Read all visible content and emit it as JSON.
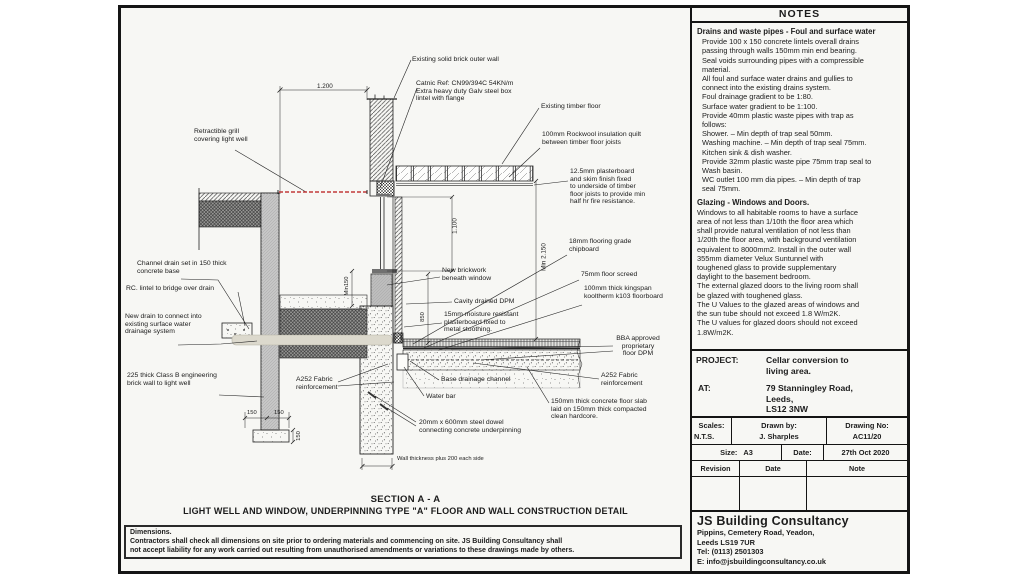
{
  "sheet": {
    "notes": {
      "title": "NOTES",
      "section1_heading": "Drains and waste pipes - Foul and surface water",
      "section1_lines": [
        "Provide 100 x 150 concrete lintels overall drains",
        "passing through walls 150mm min end bearing.",
        "Seal voids surrounding pipes with a compressible",
        "material.",
        "All foul and surface water drains and gullies to",
        "connect into the existing drains system.",
        "Foul drainage gradient to be 1:80.",
        "Surface water gradient to be 1:100.",
        "Provide 40mm plastic waste pipes with trap as",
        "follows:",
        "Shower. – Min depth of trap seal 50mm.",
        "Washing machine. – Min depth of trap seal 75mm.",
        "Kitchen sink & dish washer.",
        "Provide 32mm plastic waste pipe 75mm trap seal to",
        "Wash basin.",
        "WC outlet 100 mm dia pipes. – Min depth of trap",
        "seal 75mm."
      ],
      "section2_heading": "Glazing - Windows and Doors.",
      "section2_lines": [
        "Windows to all habitable rooms to have a surface",
        "area of not less than 1/10th the floor area which",
        "shall provide natural  ventilation of not less than",
        "1/20th the floor area, with background ventilation",
        "equivalent to 8000mm2. Install in the outer wall",
        "355mm diameter Velux Suntunnel with",
        "toughened glass to provide  supplementary",
        "daylight to the basement bedroom.",
        "The external glazed doors to the living room shall",
        "be glazed with toughened glass.",
        "The U Values to the glazed areas of windows and",
        "the sun tube should not exceed 1.8 W/m2K.",
        "The U values for glazed doors should not exceed",
        "1.8W/m2K."
      ]
    },
    "project": {
      "label": "PROJECT:",
      "value": "Cellar conversion to\nliving area.",
      "at_label": "AT:",
      "at_value": "79 Stanningley Road,\nLeeds,\nLS12 3NW"
    },
    "titleblock": {
      "scales_label": "Scales:",
      "scales": "N.T.S.",
      "drawn_label": "Drawn by:",
      "drawn": "J. Sharples",
      "no_label": "Drawing No:",
      "no": "AC11/20",
      "size_label": "Size:",
      "size": "A3",
      "date_label": "Date:",
      "date": "27th Oct 2020",
      "rev_header": "Revision",
      "rev_date_header": "Date",
      "rev_note_header": "Note"
    },
    "firm": {
      "name": "JS Building Consultancy",
      "address1": "Pippins, Cemetery Road, Yeadon,",
      "address2": "Leeds LS19 7UR",
      "tel": "Tel: (0113) 2501303",
      "email": "E: info@jsbuildingconsultancy.co.uk"
    },
    "caption": {
      "title": "SECTION A - A",
      "subtitle": "LIGHT WELL AND WINDOW, UNDERPINNING TYPE \"A\"  FLOOR AND WALL CONSTRUCTION DETAIL"
    },
    "disclaimer": {
      "heading": "Dimensions.",
      "line1": "Contractors shall check all dimensions on site prior to ordering materials and commencing on site. JS Building Consultancy shall",
      "line2": " not accept liability for any  work carried out resulting from unauthorised  amendments or variations to these  drawings made by others."
    },
    "drawing": {
      "labels": {
        "existing_wall": "Existing solid brick outer wall",
        "catnic": "Catnic Ref: CN99/394C 54KN/m\nExtra heavy duty Galv steel box\nlintel with flange",
        "timber_floor": "Existing timber floor",
        "rockwool": "100mm Rockwool insulation quilt\nbetween timber floor joists",
        "plasterboard": "12.5mm plasterboard\nand skim finish fixed\nto underside of timber\nfloor joists to provide min\nhalf hr fire resistance.",
        "grill": "Retractible grill\ncovering light well",
        "channel_drain": "Channel drain set in 150 thick\nconcrete base",
        "rc_lintel": "RC. lintel to bridge over drain",
        "new_drain": "New drain to connect into\nexisting surface water\ndrainage system",
        "brick_225": "225 thick Class B engineering\nbrick wall to light well",
        "new_brickwork": "New brickwork\nbeneath window",
        "cavity_dpm": "Cavity drained DPM",
        "moisture_pb": "15mm moisture resistant\nplasterboard  fixed  to\nmetal stoothing.",
        "chipboard": "18mm flooring grade\nchipboard",
        "screed": "75mm floor screed",
        "kingspan": "100mm thick kingspan\nkooltherm k103 floorboard",
        "bba": "BBA approved\nproprietary\nfloor DPM",
        "a252_right": "A252 Fabric\nreinforcement",
        "a252_left": "A252 Fabric\nreinforcement",
        "base_channel": "Base drainage channel",
        "water_bar": "Water bar",
        "dowel": "20mm x 600mm steel dowel\nconnecting concrete underpinning",
        "slab": "150mm thick concrete floor slab\nlaid on 150mm thick compacted\nclean hardcore.",
        "wall_thickness": "Wall thickness plus 200 each side"
      },
      "dims": {
        "top": "1.200",
        "window": "1.100",
        "room": "Min 2.150",
        "sill": "Min150",
        "d850": "850",
        "foot_left": "150",
        "foot_right": "150",
        "foot_depth": "150"
      },
      "colors": {
        "grill_red": "#c23a3a"
      }
    }
  }
}
